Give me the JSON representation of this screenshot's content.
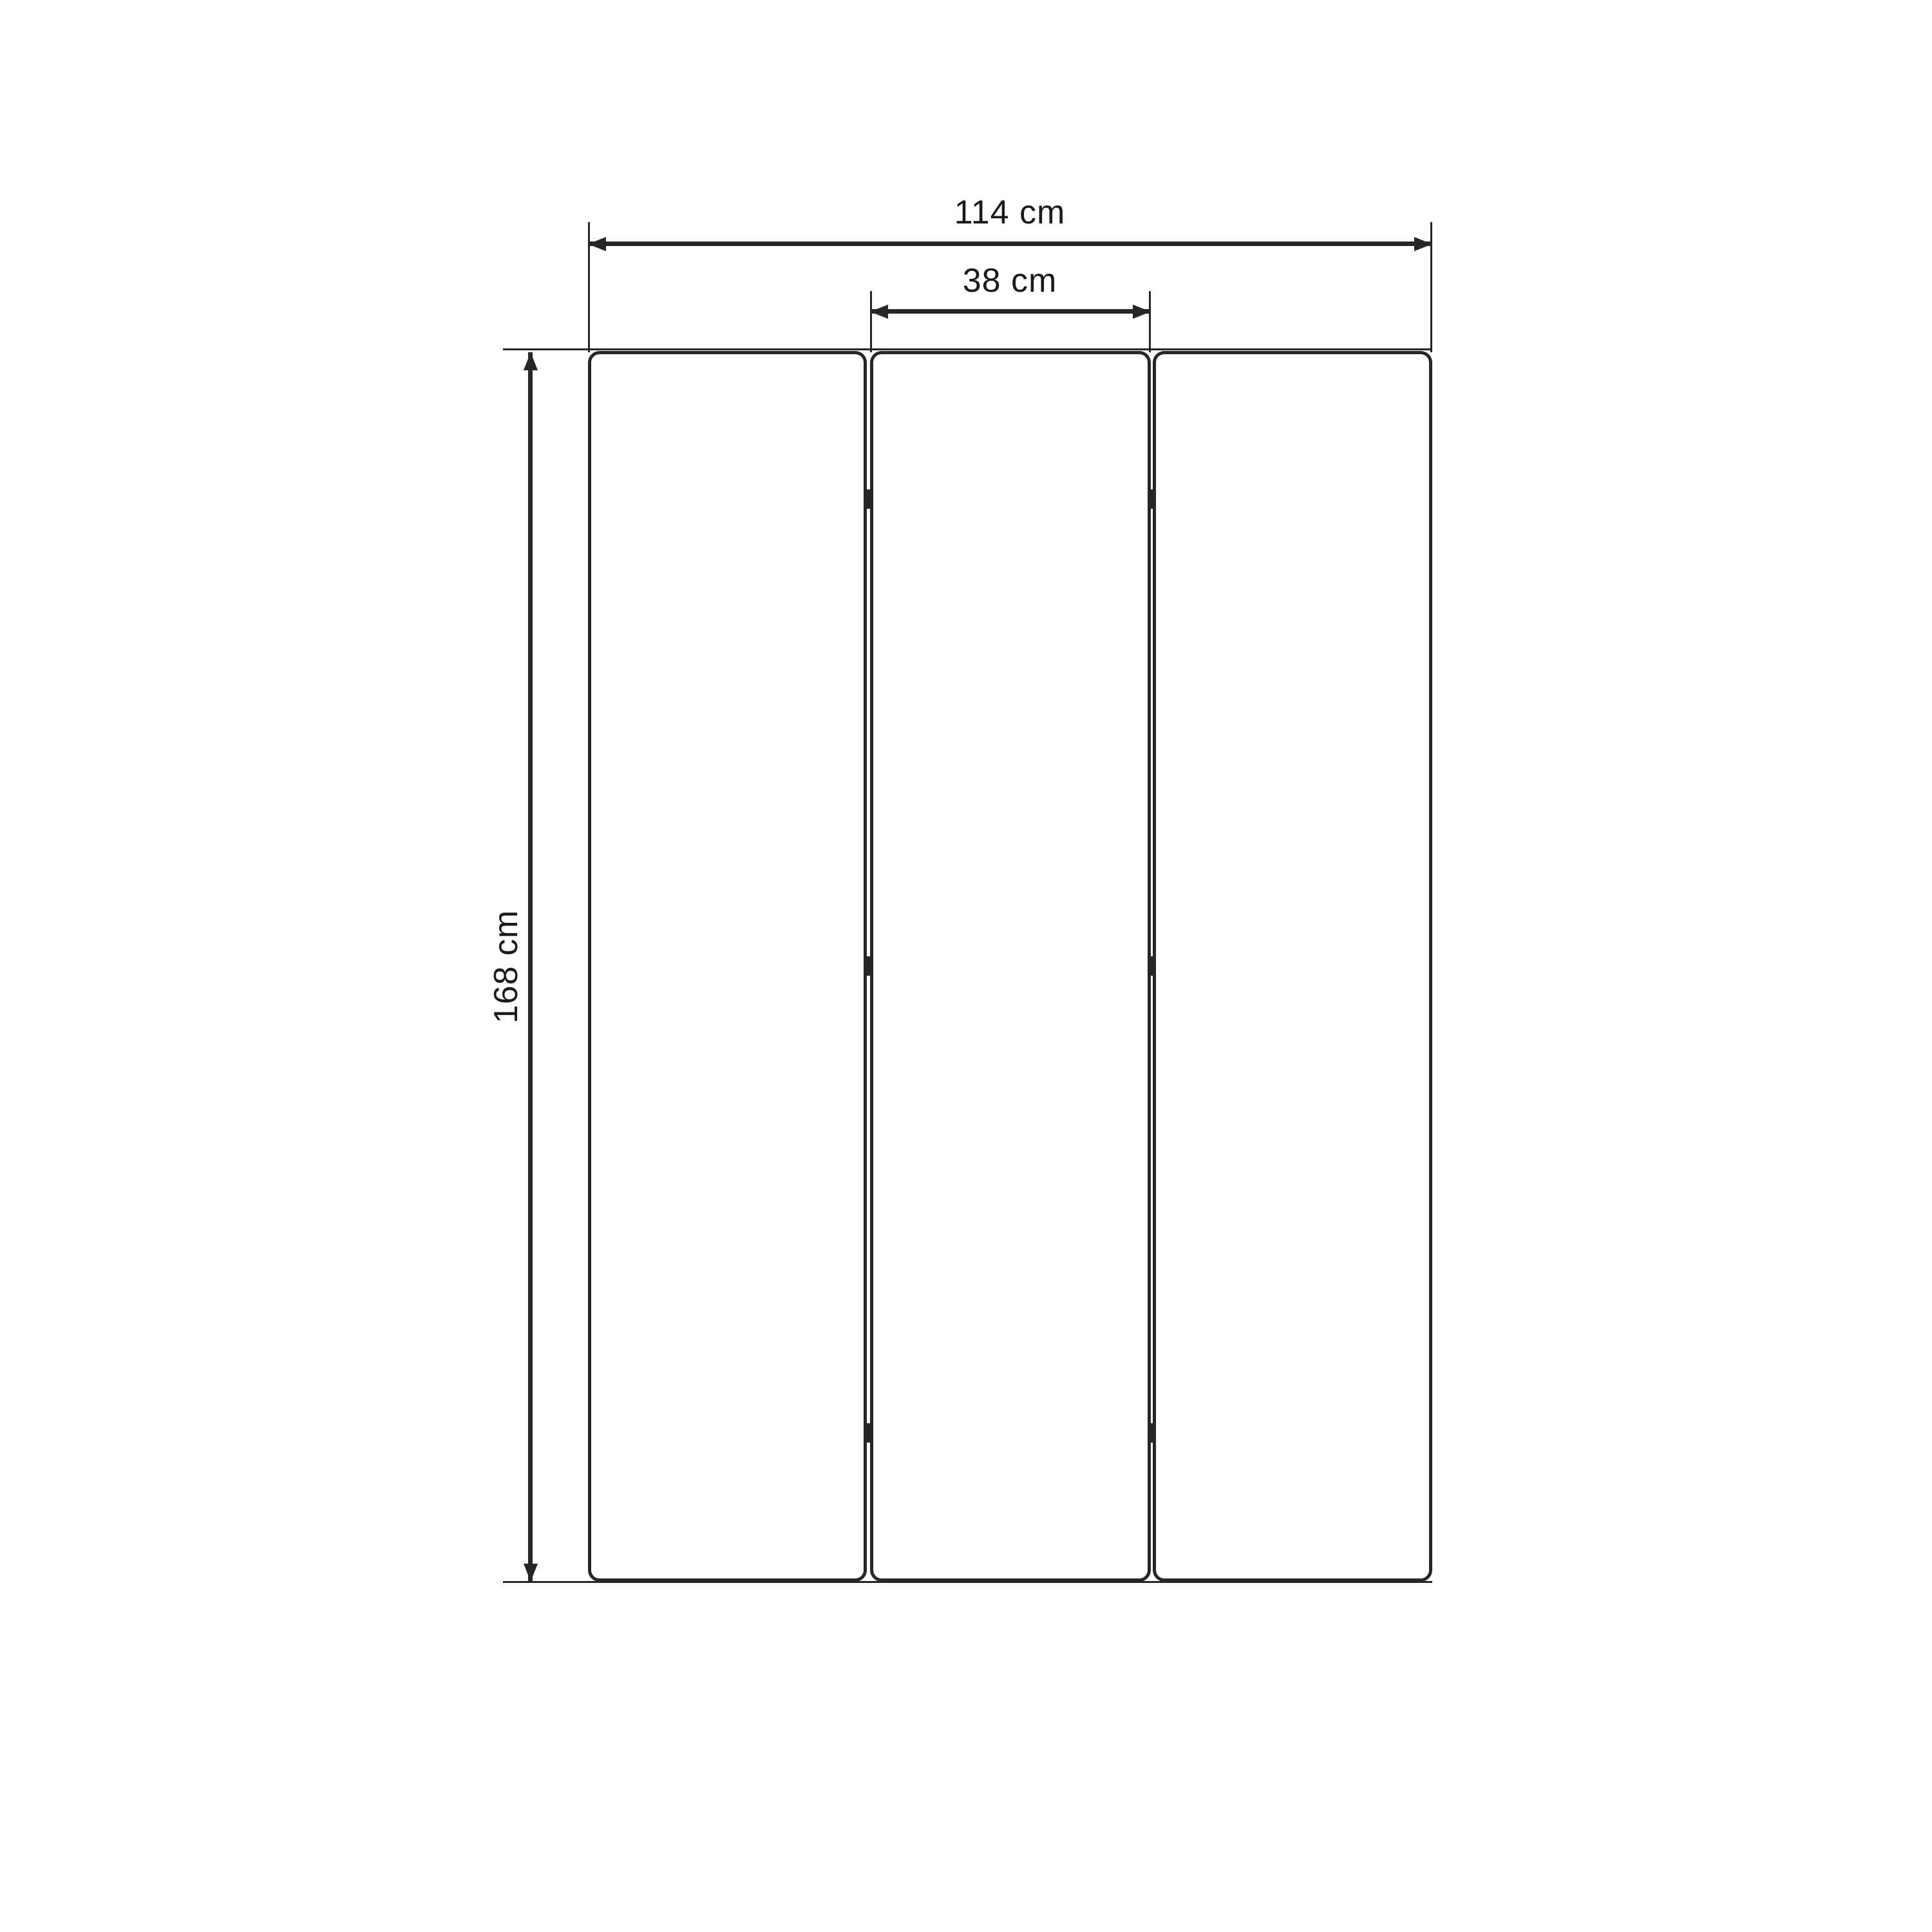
{
  "diagram": {
    "type": "technical-drawing",
    "panel_count": 3,
    "colors": {
      "line": "#262626",
      "text": "#1a1a1a",
      "background": "#ffffff"
    },
    "dimensions": {
      "total_width": {
        "label": "114 cm",
        "value": 114,
        "unit": "cm",
        "orientation": "horizontal"
      },
      "panel_width": {
        "label": "38 cm",
        "value": 38,
        "unit": "cm",
        "orientation": "horizontal"
      },
      "height": {
        "label": "168 cm",
        "value": 168,
        "unit": "cm",
        "orientation": "vertical"
      }
    }
  }
}
